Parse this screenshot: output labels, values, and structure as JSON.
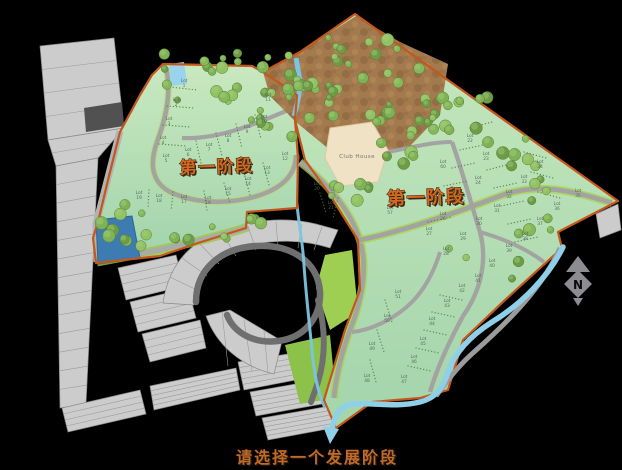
{
  "caption": {
    "text": "请选择一个发展阶段"
  },
  "phases": {
    "west": {
      "label": "第一阶段"
    },
    "east": {
      "label": "第一阶段"
    }
  },
  "club_house": {
    "label": "Club House"
  },
  "compass": {
    "label": "N"
  },
  "lots": {
    "prefix": "Lot",
    "items": [
      [
        "1",
        184,
        82
      ],
      [
        "2",
        176,
        101
      ],
      [
        "3",
        169,
        120
      ],
      [
        "4",
        163,
        139
      ],
      [
        "5",
        166,
        157
      ],
      [
        "6",
        188,
        151
      ],
      [
        "7",
        209,
        146
      ],
      [
        "8",
        228,
        137
      ],
      [
        "9",
        247,
        128
      ],
      [
        "10",
        264,
        118
      ],
      [
        "11",
        268,
        96
      ],
      [
        "12",
        285,
        155
      ],
      [
        "13",
        267,
        169
      ],
      [
        "14",
        248,
        180
      ],
      [
        "15",
        228,
        190
      ],
      [
        "16",
        208,
        199
      ],
      [
        "17",
        184,
        198
      ],
      [
        "18",
        159,
        197
      ],
      [
        "19",
        139,
        194
      ],
      [
        "20",
        317,
        185
      ],
      [
        "21",
        331,
        204
      ],
      [
        "57",
        390,
        209
      ],
      [
        "22",
        470,
        137
      ],
      [
        "23",
        486,
        155
      ],
      [
        "60",
        443,
        163
      ],
      [
        "24",
        478,
        179
      ],
      [
        "34",
        540,
        163
      ],
      [
        "33",
        524,
        178
      ],
      [
        "25",
        462,
        197
      ],
      [
        "32",
        509,
        193
      ],
      [
        "26",
        443,
        215
      ],
      [
        "31",
        497,
        207
      ],
      [
        "30",
        479,
        220
      ],
      [
        "35",
        578,
        192
      ],
      [
        "36",
        557,
        205
      ],
      [
        "27",
        429,
        230
      ],
      [
        "29",
        463,
        235
      ],
      [
        "37",
        540,
        220
      ],
      [
        "28",
        446,
        250
      ],
      [
        "38",
        525,
        235
      ],
      [
        "39",
        509,
        247
      ],
      [
        "40",
        492,
        262
      ],
      [
        "41",
        478,
        277
      ],
      [
        "42",
        462,
        287
      ],
      [
        "43",
        447,
        302
      ],
      [
        "51",
        398,
        293
      ],
      [
        "44",
        432,
        320
      ],
      [
        "50",
        387,
        317
      ],
      [
        "45",
        423,
        340
      ],
      [
        "49",
        372,
        345
      ],
      [
        "46",
        414,
        358
      ],
      [
        "48",
        367,
        377
      ],
      [
        "47",
        404,
        378
      ]
    ]
  },
  "colors": {
    "background": "#000000",
    "boundary_orange": "#c4571c",
    "phase_label": "#d2691e",
    "caption_text": "#c06a2a",
    "site_green": "#b7dfa9",
    "gray_lots": "#cccccc",
    "road_gray": "#a3a3a1",
    "verge_green": "#a8d44a",
    "river_blue": "#8fd0e8",
    "pond_blue": "#3c7cb0",
    "terrain_brown": "#a3794e",
    "tree_green": "#7fb254",
    "compass_gray": "#8c8c92"
  }
}
